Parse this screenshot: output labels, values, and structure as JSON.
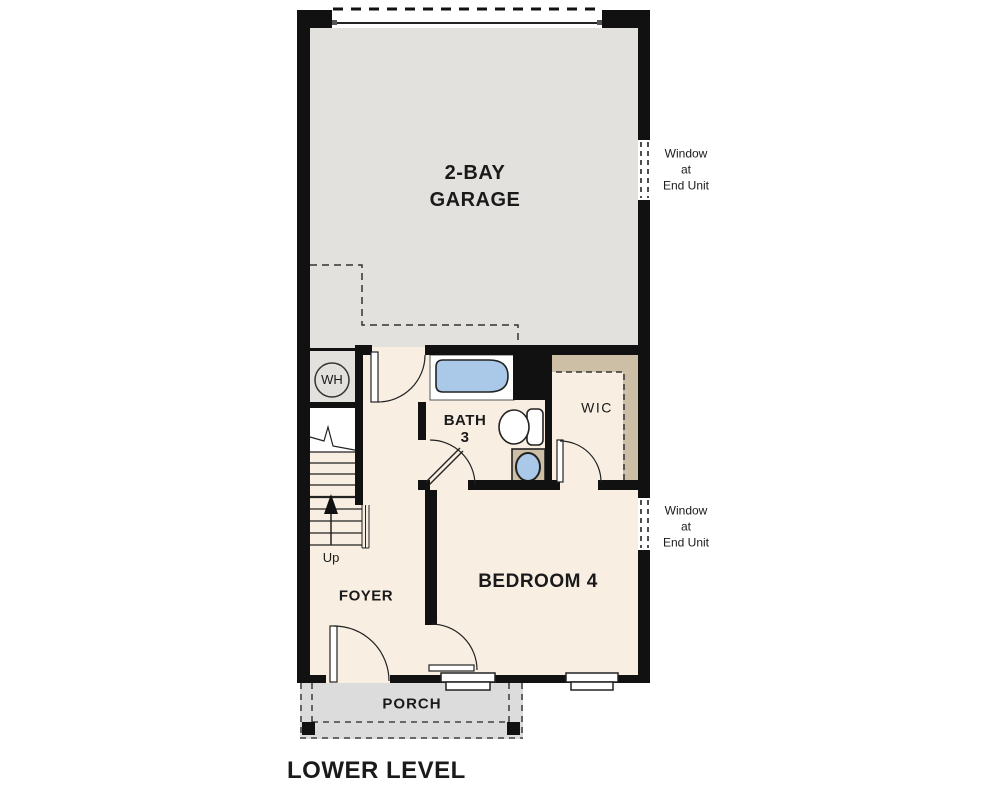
{
  "title": "LOWER LEVEL",
  "colors": {
    "wall": "#111111",
    "garage": "#e2e1de",
    "floor": "#f8efe2",
    "tan": "#cdbfa6",
    "blue": "#aac9e9",
    "porch": "#dcdcdc",
    "line": "#222222"
  },
  "rooms": {
    "garage": {
      "line1": "2-BAY",
      "line2": "GARAGE"
    },
    "bath": {
      "line1": "BATH",
      "line2": "3"
    },
    "wic": {
      "label": "WIC"
    },
    "bedroom": {
      "label": "BEDROOM 4"
    },
    "foyer": {
      "label": "FOYER"
    },
    "porch": {
      "label": "PORCH"
    }
  },
  "fixtures": {
    "water_heater": {
      "label": "WH"
    },
    "stairs": {
      "direction_label": "Up"
    }
  },
  "annotations": {
    "window_end_unit_1": {
      "lines": [
        "Window",
        "at",
        "End Unit"
      ]
    },
    "window_end_unit_2": {
      "lines": [
        "Window",
        "at",
        "End Unit"
      ]
    }
  }
}
